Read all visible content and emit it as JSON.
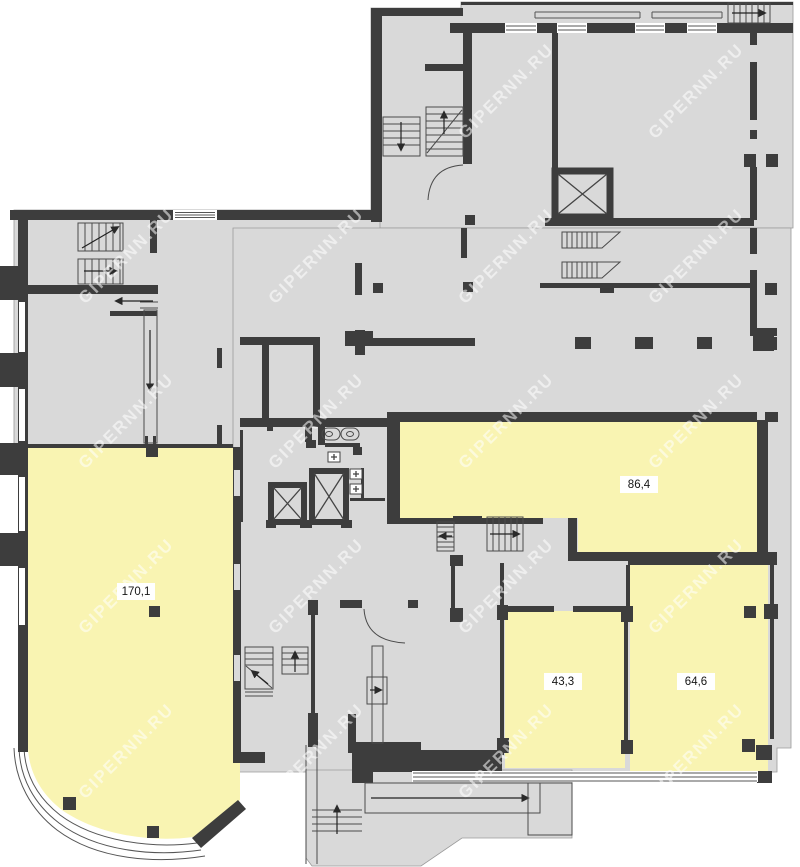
{
  "rooms": [
    {
      "id": "room-170-1",
      "area": "170,1"
    },
    {
      "id": "room-86-4",
      "area": "86,4"
    },
    {
      "id": "room-43-3",
      "area": "43,3"
    },
    {
      "id": "room-64-6",
      "area": "64,6"
    }
  ],
  "watermark": {
    "text": "GIPERNN.RU"
  },
  "colors": {
    "floor": "#d9d9d9",
    "wall": "#3d3d3d",
    "room": "#f9f4b2",
    "thin": "#4a4a4a",
    "outside": "#ffffff",
    "wm": "rgba(255,255,255,0.55)",
    "label_bg": "#ffffff",
    "label_text": "#151515"
  }
}
